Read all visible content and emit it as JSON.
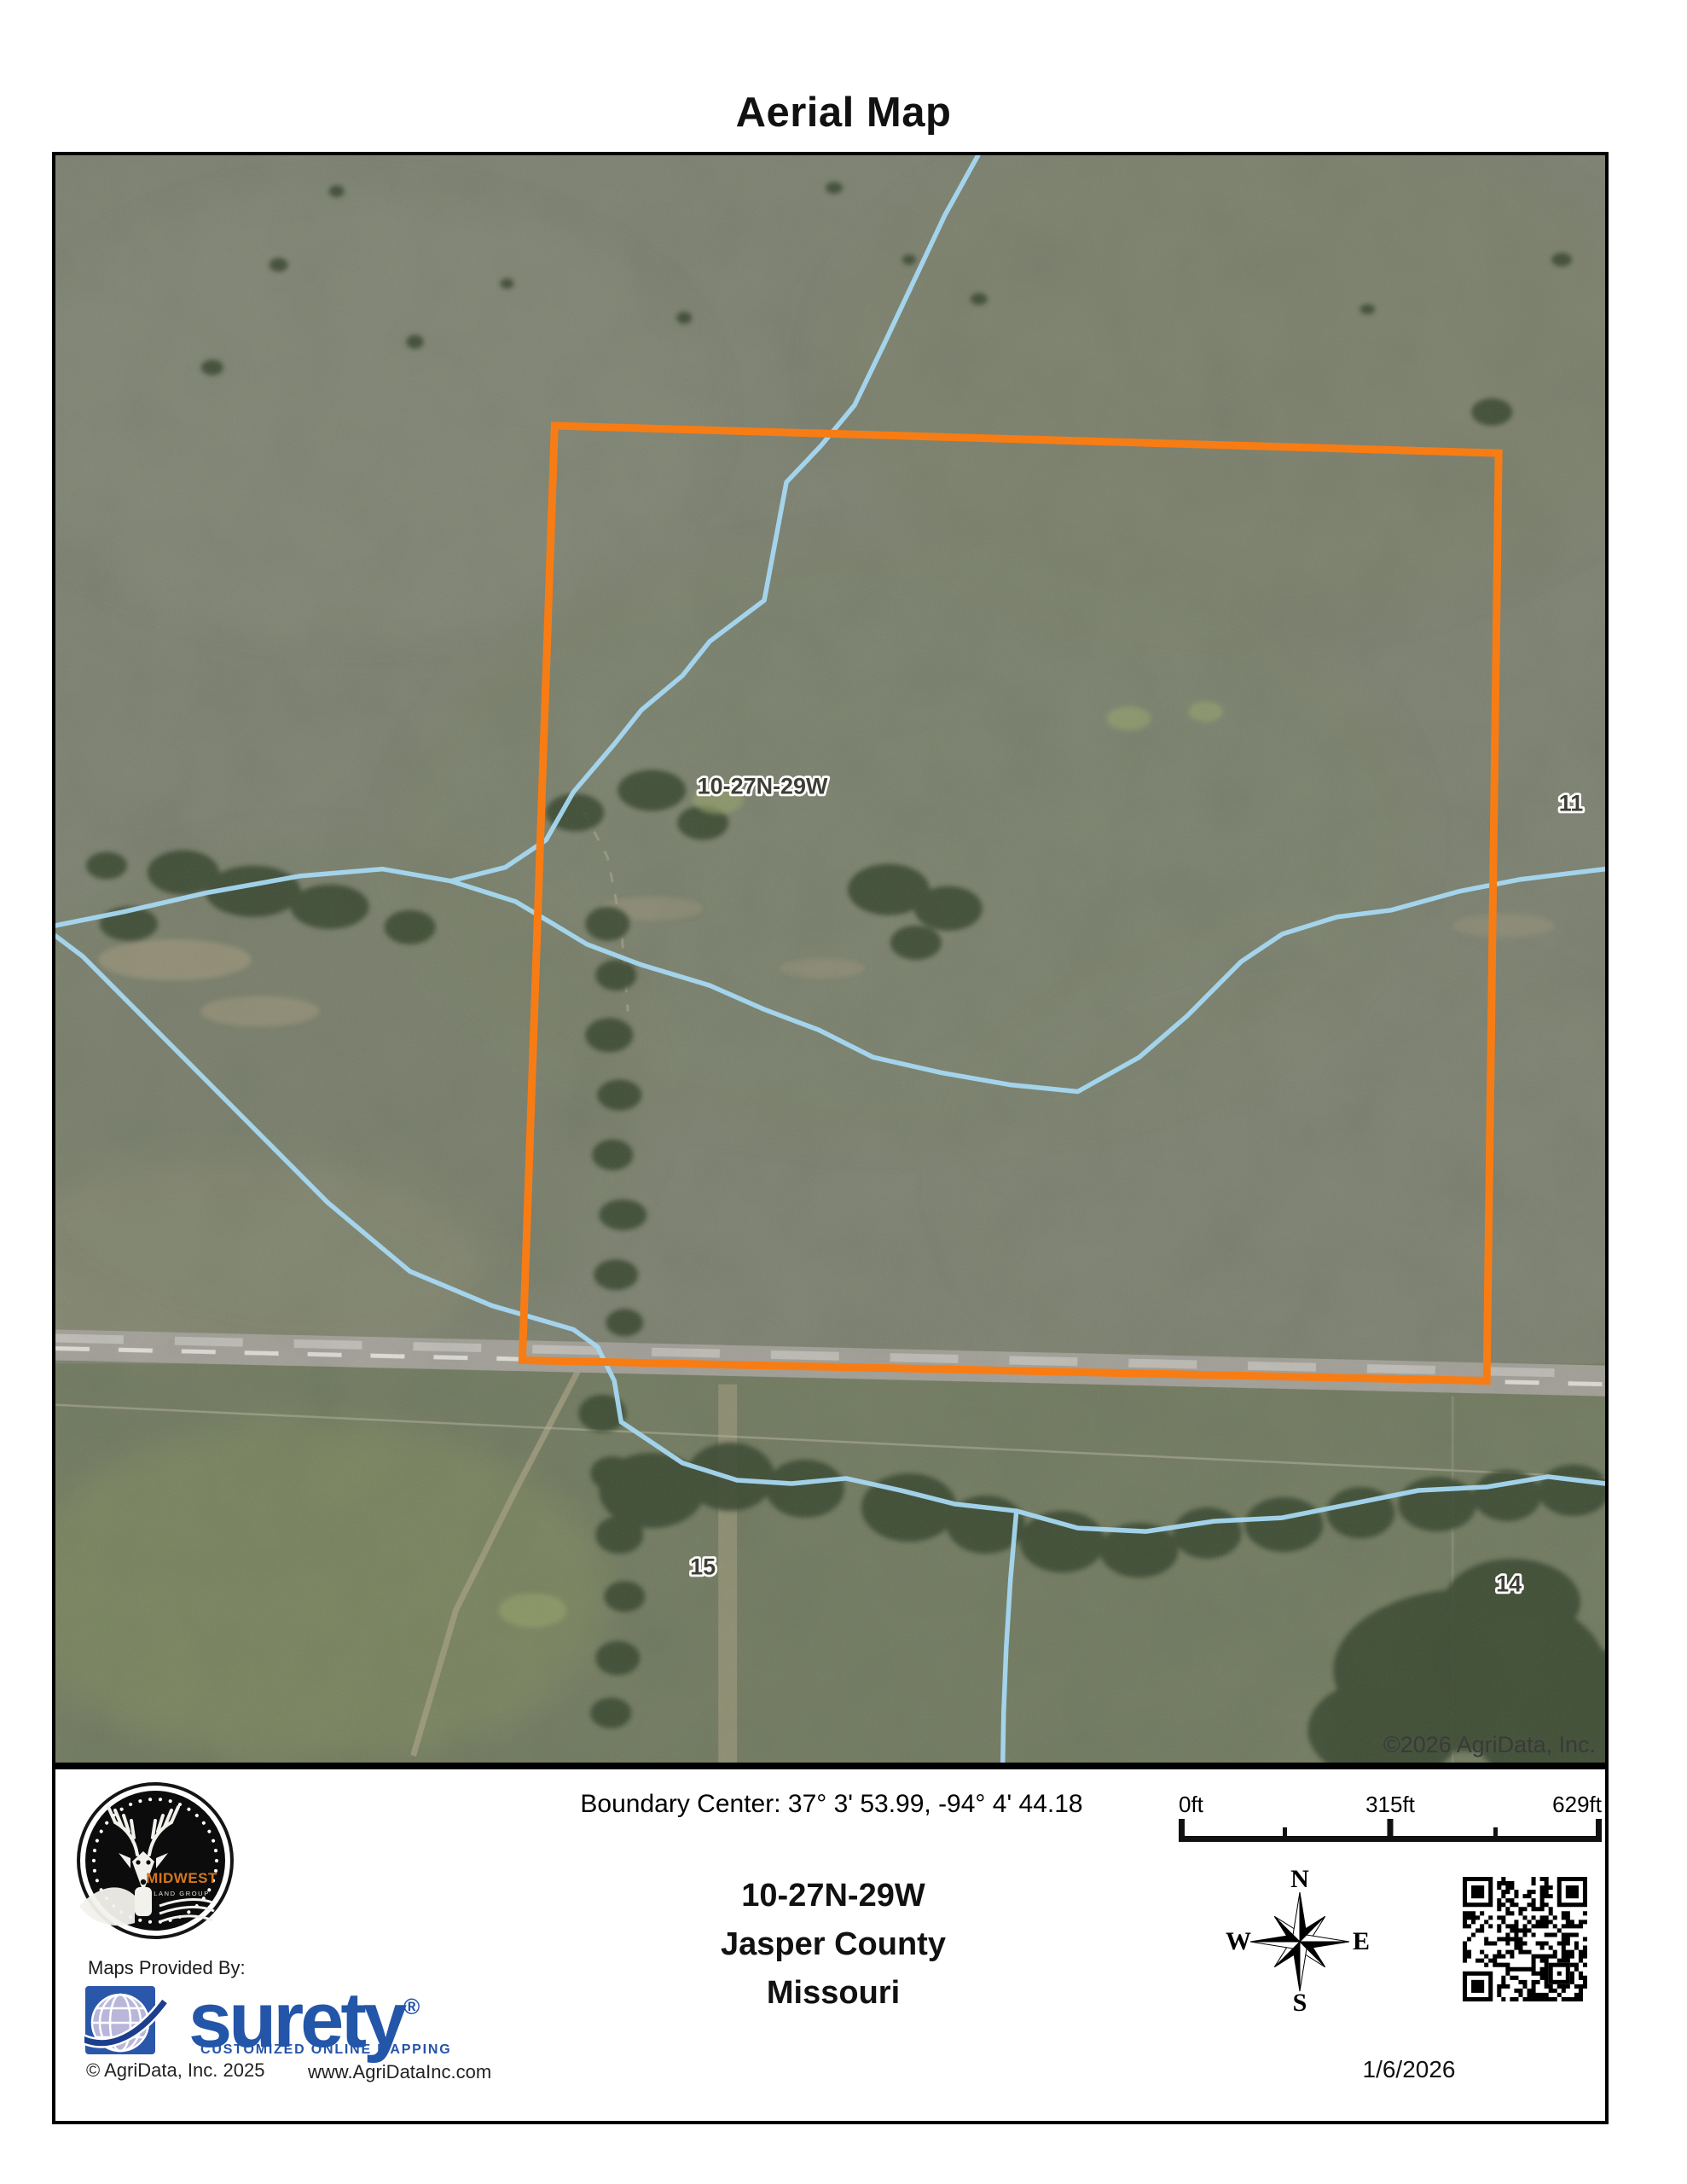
{
  "title": "Aerial Map",
  "map_overlay": {
    "plss_label": "10-27N-29W",
    "section_right": "11",
    "section_bottom_left": "15",
    "section_bottom_right": "14",
    "copyright": "©2026 AgriData, Inc.",
    "boundary_color": "#F87C14",
    "stream_color": "#A6D8F2"
  },
  "footer": {
    "boundary_center": "Boundary Center: 37° 3' 53.99,  -94° 4' 44.18",
    "trs": "10-27N-29W",
    "county": "Jasper County",
    "state": "Missouri",
    "maps_provided_by": "Maps Provided By:",
    "brand": "surety",
    "brand_mark": "®",
    "brand_tagline": "CUSTOMIZED ONLINE MAPPING",
    "agridata_copyright": "© AgriData, Inc. 2025",
    "website": "www.AgriDataInc.com",
    "date": "1/6/2026",
    "scalebar": {
      "t0": "0ft",
      "t1": "315ft",
      "t2": "629ft"
    },
    "compass": {
      "n": "N",
      "e": "E",
      "s": "S",
      "w": "W"
    },
    "logo": {
      "midwest": "MIDWEST",
      "land_group": "LAND GROUP"
    }
  }
}
